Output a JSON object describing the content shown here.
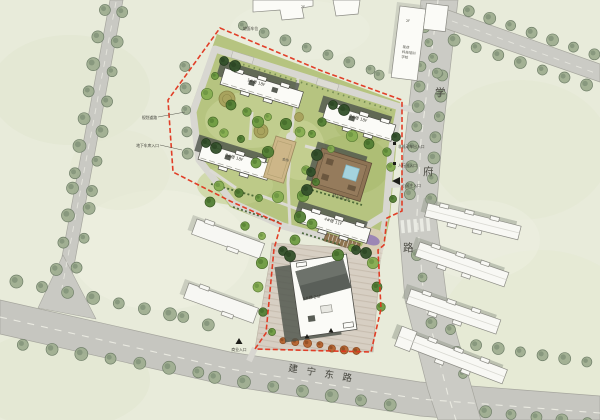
{
  "plan": {
    "kind": "residential-site-master-plan"
  },
  "colors": {
    "background": "#e8ebda",
    "road": "#c8c8c2",
    "road_edge": "#a6a69e",
    "site_lawn": "#b6c480",
    "tree_street": "#9fae90",
    "tree_green": "#6e9b41",
    "tree_autumn": "#b5622e",
    "building_fill": "#fbfbf7",
    "building_outline": "#4c4c46",
    "shadow": "#4e544c",
    "boundary_red": "#e0361f",
    "kindergarten_brown": "#8d7354",
    "pool_blue": "#a5d3de",
    "plaza_paving": "#d7cfc3",
    "court_tan": "#cdb688"
  },
  "roads": {
    "xuefu": [
      "学",
      "府",
      "路"
    ],
    "jianning": [
      "建",
      "宁",
      "东",
      "路"
    ]
  },
  "entrances": {
    "main": "小区主入口",
    "non_motor": "非机动车出入口",
    "pedestrian": "人行出入口",
    "commercial": "商业入口",
    "garage": "地下车库入口"
  },
  "notes": {
    "planned_road": "规划道路",
    "surface_parking": "地面车位"
  },
  "buildings": {
    "b1": "1#楼 18F",
    "b2": "2#楼 18F",
    "b3": "3#楼 18F",
    "b4": "4#楼 11F",
    "tower": "5#楼 24F",
    "kindergarten": "幼儿园 3F",
    "clubhouse": "会所",
    "ne_line1": "现状",
    "ne_line2": "科技培训",
    "ne_line3": "学校",
    "ne_floors": "2F",
    "top_floors": "2F"
  }
}
